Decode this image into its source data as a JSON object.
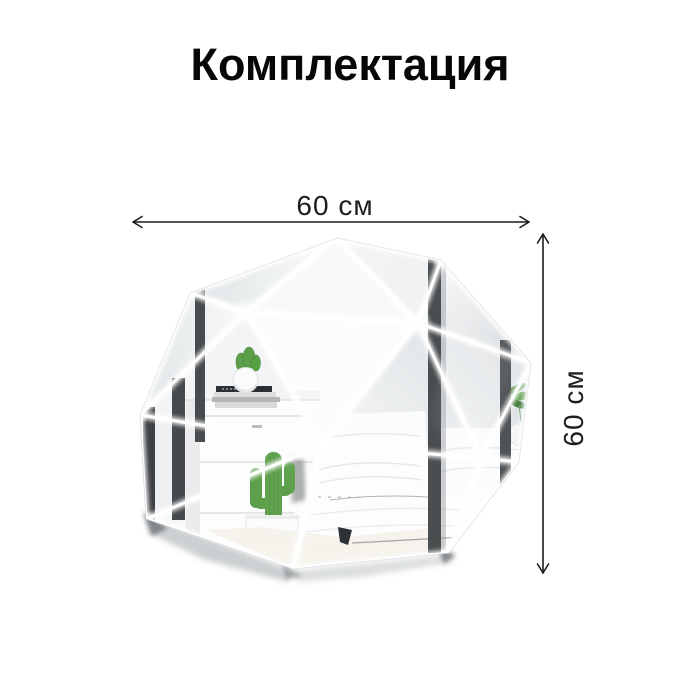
{
  "title": {
    "text": "Комплектация"
  },
  "dimensions": {
    "width_label": "60 см",
    "height_label": "60 см"
  },
  "colors": {
    "background": "#ffffff",
    "title_text": "#070707",
    "dimension_text": "#1e1e1e",
    "arrow": "#1c1c1c",
    "mirror_seam": "#ffffff",
    "facet_light": "#f7f8f9",
    "facet_shade": "#d5d9dc",
    "wardrobe_stripe": "#3d4144",
    "cactus_green": "#5d9e4b",
    "floor_shadow": "#b7bcbe"
  }
}
